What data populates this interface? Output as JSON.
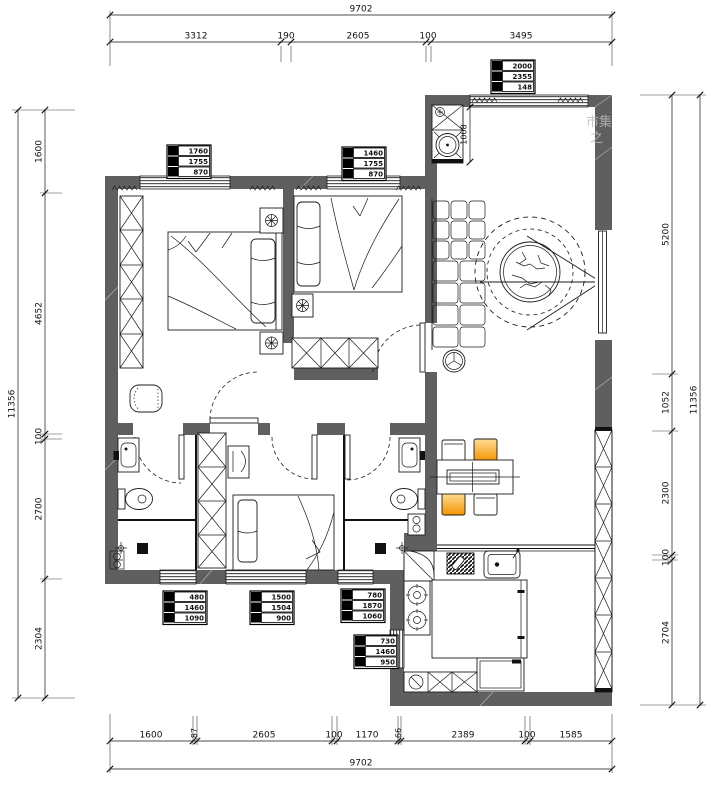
{
  "drawing": {
    "title": "apartment-floor-plan",
    "dims": {
      "top": {
        "total": "9702",
        "chain": [
          "3312",
          "190",
          "2605",
          "100",
          "3495"
        ]
      },
      "bottom": {
        "total": "9702",
        "chain": [
          "1600",
          "87",
          "2605",
          "100",
          "1170",
          "66",
          "2389",
          "100",
          "1585"
        ]
      },
      "left": {
        "total": "11356",
        "chain": [
          "1600",
          "4652",
          "100",
          "2700",
          "2304"
        ]
      },
      "right": {
        "total": "11356",
        "chain": [
          "5200",
          "1052",
          "2300",
          "100",
          "2704"
        ]
      },
      "interior": {
        "entry_cabinet": "1008"
      }
    },
    "window_tags": {
      "bedroom1": [
        "1760",
        "1755",
        "870"
      ],
      "bedroom2": [
        "1460",
        "1755",
        "870"
      ],
      "living": [
        "2000",
        "2355",
        "148"
      ],
      "bath_left": [
        "480",
        "1460",
        "1090"
      ],
      "bedroom3": [
        "1500",
        "1504",
        "900"
      ],
      "bath_right": [
        "780",
        "1870",
        "1060"
      ],
      "kitchen": [
        "730",
        "1460",
        "950"
      ]
    },
    "watermark": {
      "line1": "市集",
      "line2": "之"
    },
    "colors": {
      "wall": "#5f5f5f",
      "line": "#1b1b1b",
      "chair_orange_light": "#ffdc96",
      "chair_orange_dark": "#f29500"
    }
  }
}
